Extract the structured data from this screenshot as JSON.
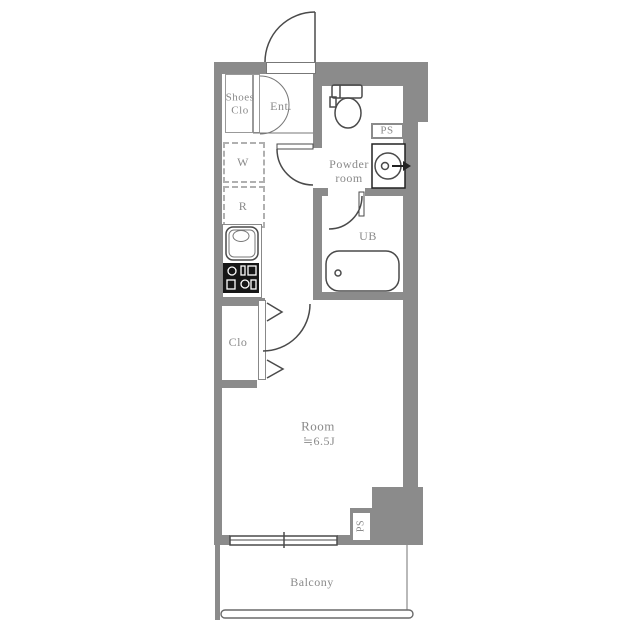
{
  "floor_plan": {
    "rooms": {
      "shoes_closet": {
        "line1": "Shoes",
        "line2": "Clo"
      },
      "entrance": {
        "label": "Ent."
      },
      "powder_room": {
        "line1": "Powder",
        "line2": "room"
      },
      "pipe_space_top": {
        "label": "PS"
      },
      "washer_placement": {
        "label": "W"
      },
      "refrigerator_placement": {
        "label": "R"
      },
      "unit_bath": {
        "label": "UB"
      },
      "closet": {
        "label": "Clo"
      },
      "main_room": {
        "name": "Room",
        "size": "≒6.5J"
      },
      "pipe_space_bottom": {
        "label": "PS"
      },
      "balcony": {
        "label": "Balcony"
      }
    },
    "colors": {
      "wall": "#8b8b8b",
      "line": "#4a4a4a",
      "text": "#8a8a8a",
      "stove": "#161616"
    }
  }
}
